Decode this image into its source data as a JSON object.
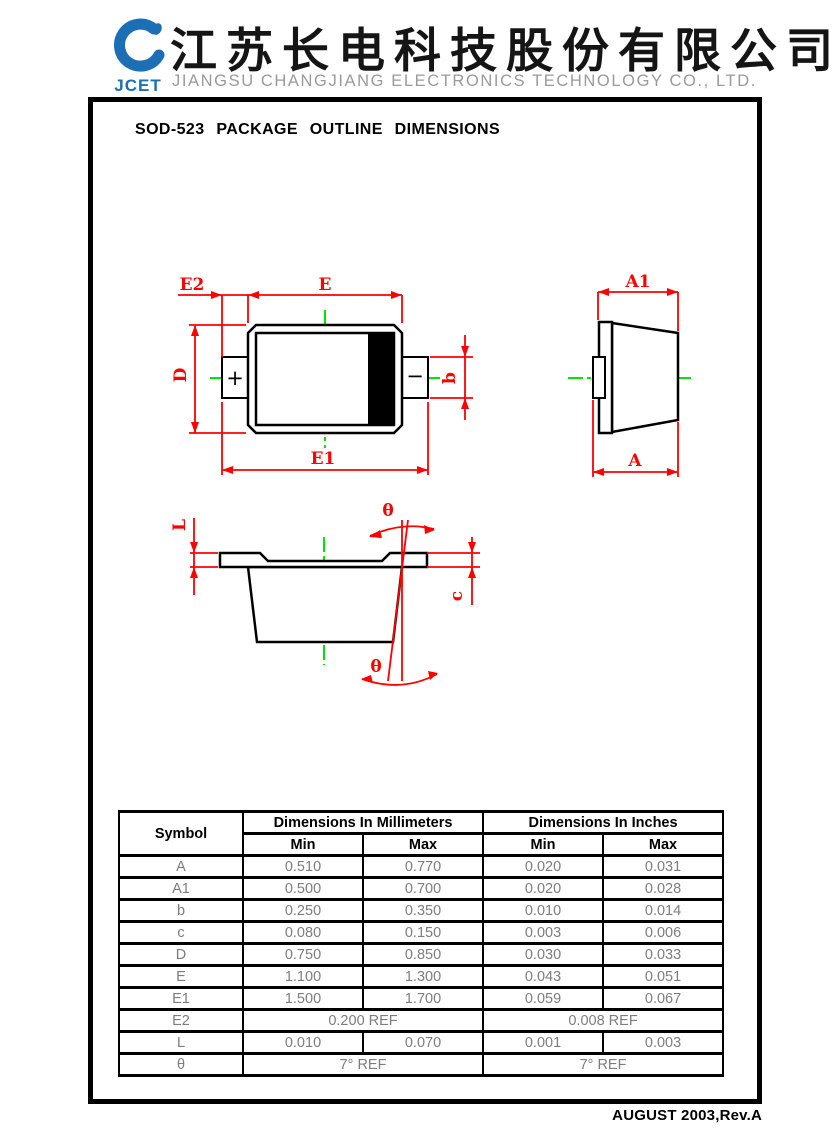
{
  "header": {
    "logo_text": "JCET",
    "company_cn": "江苏长电科技股份有限公司",
    "company_en": "JIANGSU CHANGJIANG ELECTRONICS TECHNOLOGY CO., LTD."
  },
  "title": "SOD-523 PACKAGE OUTLINE DIMENSIONS",
  "footer": "AUGUST 2003,Rev.A",
  "colors": {
    "dimension_red": "#ff0000",
    "centerline_green": "#00e400",
    "logo_blue": "#1c6fb5",
    "company_gray": "#9a9a9a",
    "cathode_band": "#000000"
  },
  "drawings": {
    "top_view": {
      "e2": "E2",
      "e": "E",
      "d": "D",
      "b": "b",
      "e1": "E1",
      "anode_mark": "+",
      "cathode_mark": "−"
    },
    "end_view": {
      "a1": "A1",
      "a": "A"
    },
    "side_view": {
      "l": "L",
      "c": "c",
      "theta_top": "θ",
      "theta_bottom": "θ"
    }
  },
  "table": {
    "symbol_header": "Symbol",
    "group_headers": {
      "mm": "Dimensions In Millimeters",
      "inch": "Dimensions In Inches"
    },
    "sub_headers": {
      "min": "Min",
      "max": "Max"
    },
    "rows": [
      {
        "symbol": "A",
        "mm_min": "0.510",
        "mm_max": "0.770",
        "in_min": "0.020",
        "in_max": "0.031"
      },
      {
        "symbol": "A1",
        "mm_min": "0.500",
        "mm_max": "0.700",
        "in_min": "0.020",
        "in_max": "0.028"
      },
      {
        "symbol": "b",
        "mm_min": "0.250",
        "mm_max": "0.350",
        "in_min": "0.010",
        "in_max": "0.014"
      },
      {
        "symbol": "c",
        "mm_min": "0.080",
        "mm_max": "0.150",
        "in_min": "0.003",
        "in_max": "0.006"
      },
      {
        "symbol": "D",
        "mm_min": "0.750",
        "mm_max": "0.850",
        "in_min": "0.030",
        "in_max": "0.033"
      },
      {
        "symbol": "E",
        "mm_min": "1.100",
        "mm_max": "1.300",
        "in_min": "0.043",
        "in_max": "0.051"
      },
      {
        "symbol": "E1",
        "mm_min": "1.500",
        "mm_max": "1.700",
        "in_min": "0.059",
        "in_max": "0.067"
      },
      {
        "symbol": "E2",
        "mm_span": "0.200 REF",
        "in_span": "0.008 REF"
      },
      {
        "symbol": "L",
        "mm_min": "0.010",
        "mm_max": "0.070",
        "in_min": "0.001",
        "in_max": "0.003"
      },
      {
        "symbol": "θ",
        "mm_span": "7° REF",
        "in_span": "7° REF"
      }
    ]
  }
}
